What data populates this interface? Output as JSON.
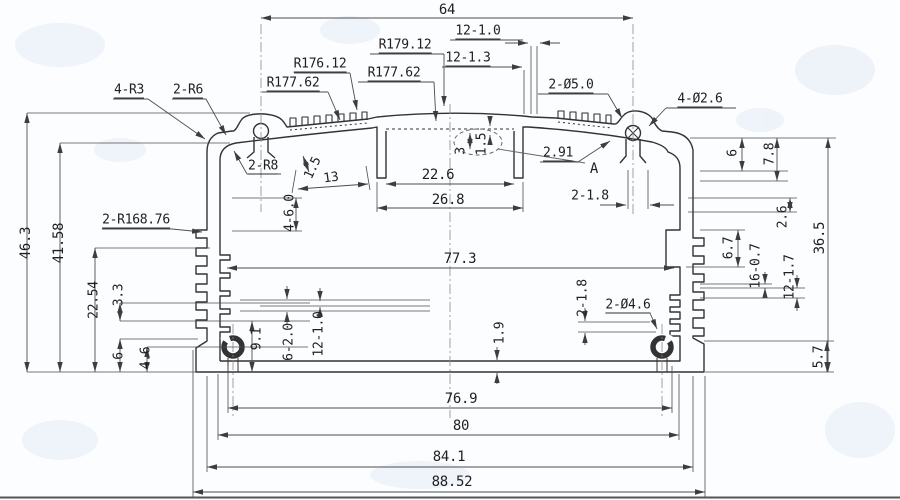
{
  "meta": {
    "type": "technical-drawing",
    "subject": "aluminum-extrusion-enclosure-cross-section",
    "detail_marker": "A"
  },
  "style": {
    "background": "#fcfdfe",
    "profile_line": "#333333",
    "dim_line": "#4d4d4d",
    "text_color": "#1f1f1f",
    "watermark": "#e4ebf5"
  },
  "drawing": {
    "labels": [
      {
        "id": "overall-top-64",
        "text": "64",
        "x": 447,
        "y": 10,
        "cls": "big"
      },
      {
        "id": "fin-count-12-1-0",
        "text": "12-1.0",
        "x": 478,
        "y": 32,
        "cls": "ul"
      },
      {
        "id": "fin-gap-12-1-3",
        "text": "12-1.3",
        "x": 468,
        "y": 59,
        "cls": "ul"
      },
      {
        "id": "radius-r179-12",
        "text": "R179.12",
        "x": 405,
        "y": 46,
        "cls": "ul"
      },
      {
        "id": "radius-r176-12",
        "text": "R176.12",
        "x": 320,
        "y": 65,
        "cls": "ul"
      },
      {
        "id": "radius-r177-62-left",
        "text": "R177.62",
        "x": 293,
        "y": 84,
        "cls": "ul"
      },
      {
        "id": "radius-r177-62-mid",
        "text": "R177.62",
        "x": 394,
        "y": 74,
        "cls": "ul"
      },
      {
        "id": "hole-2-d5-0",
        "text": "2-Ø5.0",
        "x": 571,
        "y": 86,
        "cls": "ul"
      },
      {
        "id": "hole-4-d2-6",
        "text": "4-Ø2.6",
        "x": 700,
        "y": 100,
        "cls": "ul"
      },
      {
        "id": "radius-4-r3",
        "text": "4-R3",
        "x": 129,
        "y": 91,
        "cls": "ul"
      },
      {
        "id": "radius-2-r6",
        "text": "2-R6",
        "x": 188,
        "y": 91,
        "cls": "ul"
      },
      {
        "id": "radius-2-r8",
        "text": "2-R8",
        "x": 263,
        "y": 167,
        "cls": "ul"
      },
      {
        "id": "gap-2-91",
        "text": "2.91",
        "x": 558,
        "y": 154,
        "cls": "ul"
      },
      {
        "id": "detail-a",
        "text": "A",
        "x": 594,
        "y": 169,
        "cls": "big"
      },
      {
        "id": "rib-2-1-8-top",
        "text": "2-1.8",
        "x": 590,
        "y": 196,
        "cls": ""
      },
      {
        "id": "radius-2-r168-76",
        "text": "2-R168.76",
        "x": 136,
        "y": 221,
        "cls": "ul"
      },
      {
        "id": "height-46-3",
        "text": "46.3",
        "x": 26,
        "y": 243,
        "cls": "rot big"
      },
      {
        "id": "height-41-58",
        "text": "41.58",
        "x": 59,
        "y": 243,
        "cls": "rot big"
      },
      {
        "id": "height-22-54",
        "text": "22.54",
        "x": 94,
        "y": 300,
        "cls": "rot"
      },
      {
        "id": "height-3-3",
        "text": "3.3",
        "x": 119,
        "y": 295,
        "cls": "rot"
      },
      {
        "id": "height-6-left",
        "text": "6",
        "x": 119,
        "y": 356,
        "cls": "rot"
      },
      {
        "id": "height-4-6",
        "text": "4.6",
        "x": 146,
        "y": 358,
        "cls": "rot"
      },
      {
        "id": "boss-9-1",
        "text": "9.1",
        "x": 257,
        "y": 339,
        "cls": "rot"
      },
      {
        "id": "slots-6-2-0",
        "text": "6-2.0",
        "x": 289,
        "y": 342,
        "cls": "rot"
      },
      {
        "id": "slots-12-1-0",
        "text": "12-1.0",
        "x": 319,
        "y": 334,
        "cls": "rot"
      },
      {
        "id": "wall-1-9",
        "text": "1.9",
        "x": 500,
        "y": 333,
        "cls": "rot"
      },
      {
        "id": "rib-2-1-8-bottom",
        "text": "2-1.8",
        "x": 583,
        "y": 298,
        "cls": "rot"
      },
      {
        "id": "hole-2-d4-6",
        "text": "2-Ø4.6",
        "x": 628,
        "y": 306,
        "cls": "ul"
      },
      {
        "id": "width-22-6",
        "text": "22.6",
        "x": 438,
        "y": 175,
        "cls": "big"
      },
      {
        "id": "width-26-8",
        "text": "26.8",
        "x": 448,
        "y": 200,
        "cls": "big"
      },
      {
        "id": "width-77-3",
        "text": "77.3",
        "x": 460,
        "y": 259,
        "cls": "big"
      },
      {
        "id": "pocket-4-6-0",
        "text": "4-6.0",
        "x": 290,
        "y": 213,
        "cls": "rot"
      },
      {
        "id": "step-3",
        "text": "3",
        "x": 461,
        "y": 151,
        "cls": "rot"
      },
      {
        "id": "step-1-5",
        "text": "1.5",
        "x": 482,
        "y": 144,
        "cls": "rot"
      },
      {
        "id": "fin-height-1-5",
        "text": "1.5",
        "x": 313,
        "y": 168,
        "cls": "rot65"
      },
      {
        "id": "band-13",
        "text": "13",
        "x": 331,
        "y": 178,
        "cls": "rot8"
      },
      {
        "id": "right-6",
        "text": "6",
        "x": 733,
        "y": 153,
        "cls": "rot"
      },
      {
        "id": "right-7-8",
        "text": "7.8",
        "x": 770,
        "y": 154,
        "cls": "rot"
      },
      {
        "id": "right-2-6",
        "text": "2.6",
        "x": 783,
        "y": 217,
        "cls": "rot"
      },
      {
        "id": "right-36-5",
        "text": "36.5",
        "x": 820,
        "y": 238,
        "cls": "rot big"
      },
      {
        "id": "right-6-7",
        "text": "6.7",
        "x": 729,
        "y": 248,
        "cls": "rot"
      },
      {
        "id": "right-16-0-7",
        "text": "16-0.7",
        "x": 756,
        "y": 266,
        "cls": "rot"
      },
      {
        "id": "right-12-1-7",
        "text": "12-1.7",
        "x": 790,
        "y": 277,
        "cls": "rot"
      },
      {
        "id": "right-5-7",
        "text": "5.7",
        "x": 819,
        "y": 357,
        "cls": "rot"
      },
      {
        "id": "width-76-9",
        "text": "76.9",
        "x": 461,
        "y": 399,
        "cls": "big"
      },
      {
        "id": "width-80",
        "text": "80",
        "x": 461,
        "y": 426,
        "cls": "big"
      },
      {
        "id": "width-84-1",
        "text": "84.1",
        "x": 449,
        "y": 457,
        "cls": "big"
      },
      {
        "id": "width-88-52",
        "text": "88.52",
        "x": 452,
        "y": 482,
        "cls": "big"
      }
    ]
  }
}
